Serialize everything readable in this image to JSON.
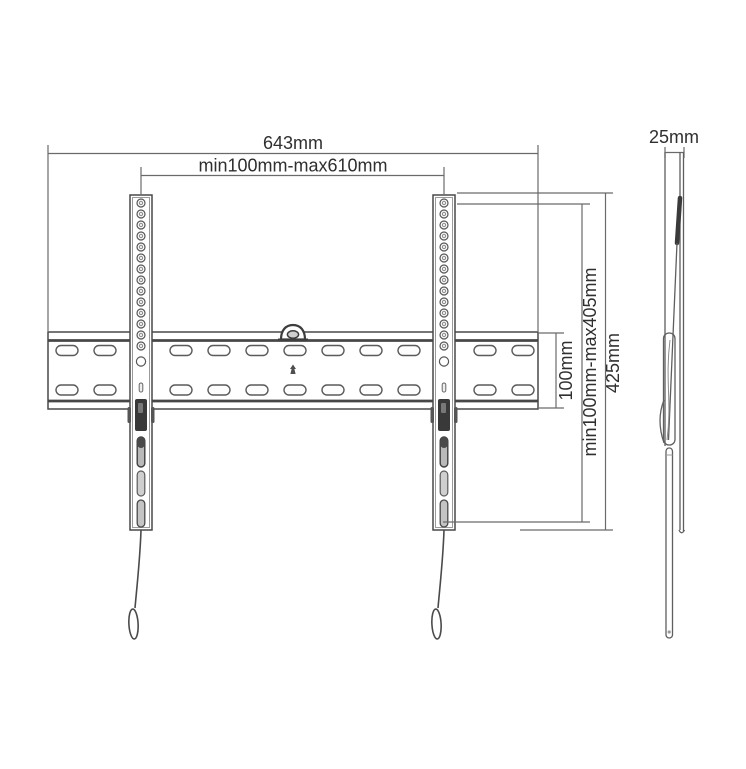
{
  "labels": {
    "total_width": "643mm",
    "horizontal_adjustment": "min100mm-max610mm",
    "depth": "25mm",
    "plate_height": "100mm",
    "vertical_adjustment": "min100mm-max405mm",
    "rail_height": "425mm"
  },
  "colors": {
    "background": "#ffffff",
    "line": "#6a6a6a",
    "dark_line": "#3d3d3d",
    "text": "#2f2f2f",
    "latch_fill": "#393939",
    "slot_fill": "#b9b9b9"
  }
}
